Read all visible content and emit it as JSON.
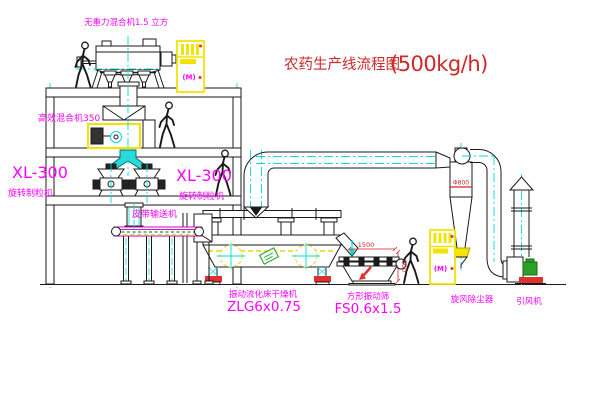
{
  "title": {
    "text": "农药生产线流程图",
    "capacity": "(500kg/h)"
  },
  "labels": {
    "gravity_mixer": "无重力混合机1.5 立方",
    "high_eff_mixer": "高效混合机350",
    "granulator_left_model": "XL-300",
    "granulator_left_name": "旋转制粒机",
    "granulator_right_model": "XL-300",
    "granulator_right_name": "旋转制粒机",
    "belt_conveyor": "皮带输送机",
    "dryer_name": "振动流化床干燥机",
    "dryer_model": "ZLG6x0.75",
    "screen_name": "方形振动筛",
    "screen_model": "FS0.6x1.5",
    "cyclone": "旋风除尘器",
    "fan": "引风机"
  },
  "dimensions": {
    "screen_length": "1500",
    "screen_height": "500",
    "cyclone_note": "Φ800"
  },
  "cabinet_symbol": "(M)",
  "colors": {
    "label_magenta": "#ff00ff",
    "title_red": "#d02828",
    "centerline_cyan": "#00dcdc",
    "cabinet_yellow": "#f2e400",
    "motor_green": "#1f9e1f",
    "conveyor_green": "#00aa00",
    "line_black": "#1a1a1a"
  }
}
